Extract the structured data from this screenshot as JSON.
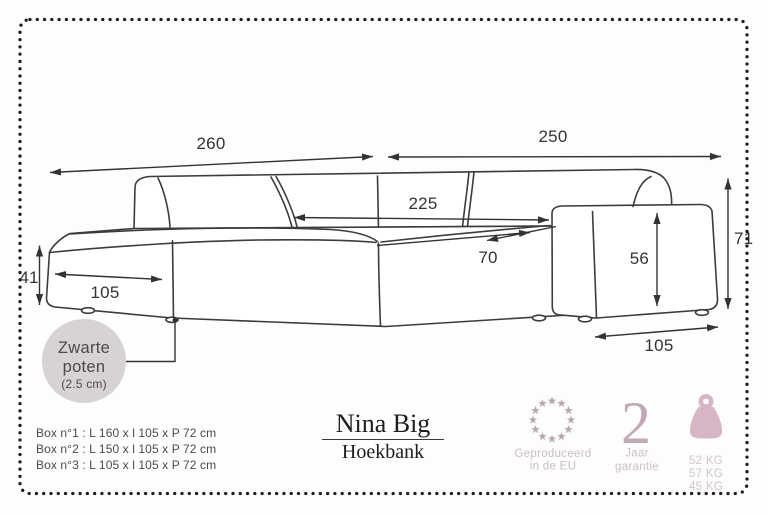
{
  "frame": {
    "dot_color": "#1e1e1e",
    "background": "#fdfdfd"
  },
  "diagram": {
    "line_color": "#3c3c3c",
    "dim_color": "#333333",
    "dimensions": {
      "chaise_total_width": "260",
      "right_total_width": "250",
      "inner_width": "225",
      "seat_depth": "70",
      "armrest_height": "56",
      "total_height": "71",
      "chaise_height": "41",
      "chaise_depth": "105",
      "armrest_depth": "105"
    },
    "legs_note": {
      "line1": "Zwarte",
      "line2": "poten",
      "line3": "(2.5 cm)",
      "bubble_color": "#d7d3d2",
      "text_color": "#4b4b4b"
    }
  },
  "product": {
    "name": "Nina Big",
    "category": "Hoekbank"
  },
  "packaging": {
    "boxes": [
      "Box n°1 : L 160 x l 105 x P 72 cm",
      "Box n°2 : L 150 x l 105 x P 72 cm",
      "Box n°3 : L 105 x l 105 x P 72 cm"
    ]
  },
  "badges": {
    "eu": {
      "line1": "Geproduceerd",
      "line2": "in de EU",
      "star_color": "#b7a5b0",
      "text_color": "#c9bec5"
    },
    "warranty": {
      "value": "2",
      "line1": "Jaar",
      "line2": "garantie",
      "number_color": "#c3a7b5",
      "text_color": "#ccc1c8"
    },
    "weight": {
      "values": [
        "52 KG",
        "57 KG",
        "45 KG"
      ],
      "icon_color": "#d6b5c4",
      "text_color": "#cfc3ca"
    }
  }
}
